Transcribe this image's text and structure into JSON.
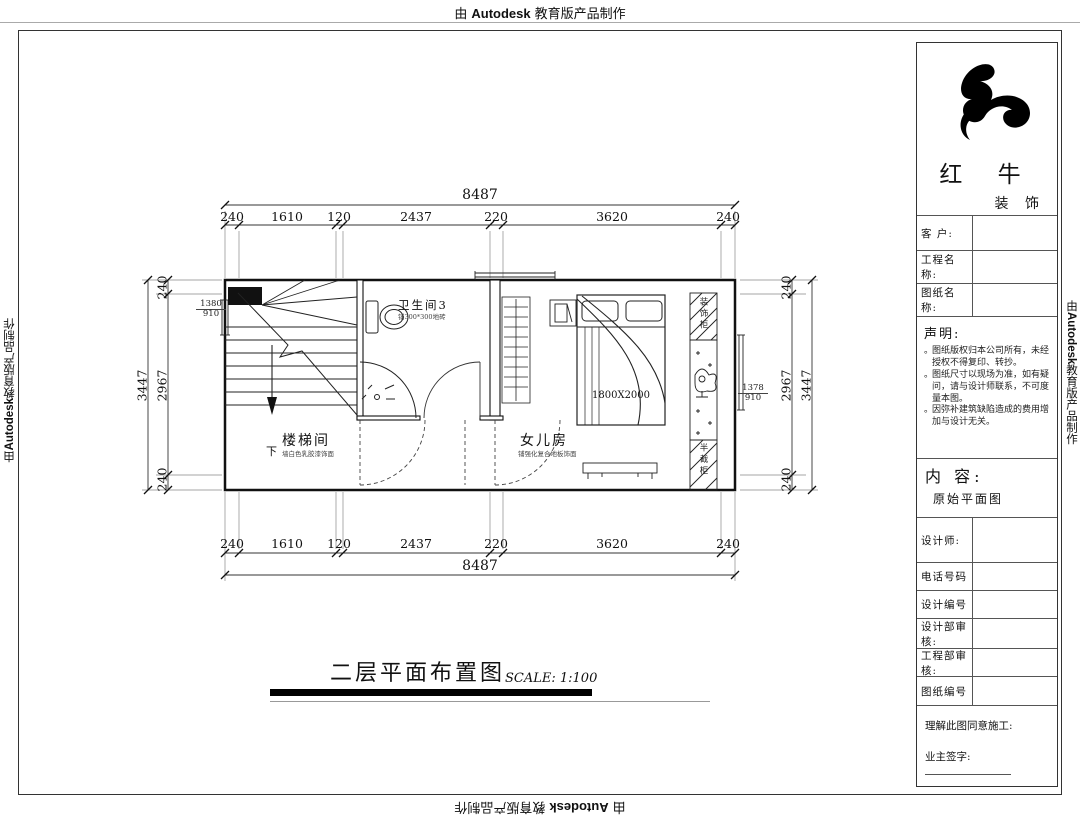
{
  "watermark": {
    "by": "由",
    "brand": "Autodesk",
    "suffix": "教育版产品制作"
  },
  "plan": {
    "title": "二层平面布置图",
    "scale": "SCALE: 1:100",
    "rooms": {
      "bath": {
        "name": "卫生间3",
        "note": "铺300*300地砖"
      },
      "stair": {
        "name": "楼梯间",
        "note": "墙白色乳胶漆饰面"
      },
      "bedroom": {
        "name": "女儿房",
        "note": "铺强化复合地板饰面"
      }
    },
    "labels": {
      "down": "下",
      "bed_size": "1800X2000",
      "cabinet_top": "装饰柜",
      "cabinet_bottom": "半截柜",
      "win_left_w": "1380",
      "win_left_h": "910",
      "win_right_w": "1378",
      "win_right_h": "910"
    },
    "dims": {
      "total": "8487",
      "segments": [
        "240",
        "1610",
        "120",
        "2437",
        "220",
        "3620",
        "240"
      ],
      "side_total": "3447",
      "side_mid": "2967",
      "side_end": "240"
    }
  },
  "title_block": {
    "company_name": "红 牛",
    "company_sub": "装 饰",
    "fields": [
      {
        "label": "客 户:"
      },
      {
        "label": "工程名称:"
      },
      {
        "label": "图纸名称:"
      }
    ],
    "statement": {
      "heading": "声明:",
      "bullet": "。",
      "items": [
        "图纸版权归本公司所有，未经授权不得复印、转抄。",
        "图纸尺寸以现场为准，如有疑问，请与设计师联系，不可度量本图。",
        "因弥补建筑缺陷造成的费用增加与设计无关。"
      ]
    },
    "content": {
      "label": "内 容:",
      "value": "原始平面图"
    },
    "rows": [
      {
        "label": "设计师:"
      },
      {
        "label": "电话号码"
      },
      {
        "label": "设计编号"
      },
      {
        "label": "设计部审核:"
      },
      {
        "label": "工程部审核:"
      },
      {
        "label": "图纸编号"
      }
    ],
    "footer": {
      "line1": "理解此图同意施工:",
      "line2": "业主签字:"
    }
  }
}
